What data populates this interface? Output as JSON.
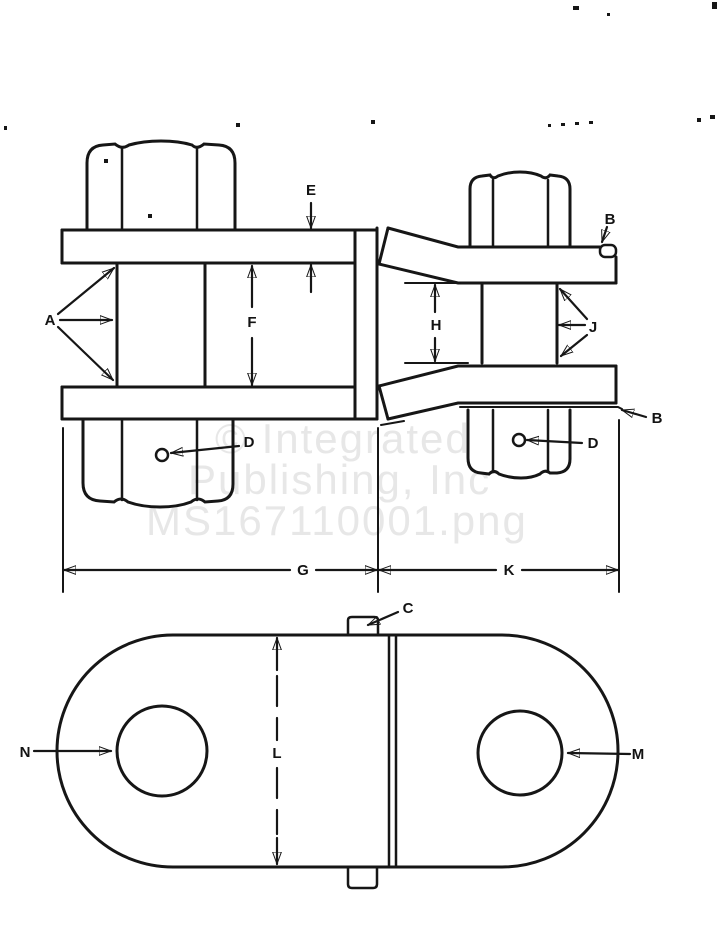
{
  "drawing": {
    "watermark": {
      "line1": "© Integrated",
      "line2": "Publishing, Inc",
      "line3": "MS167110001.png"
    },
    "labels": {
      "A": "A",
      "B_top": "B",
      "B_bottom": "B",
      "C": "C",
      "D_left": "D",
      "D_right": "D",
      "E": "E",
      "F": "F",
      "G": "G",
      "H": "H",
      "J": "J",
      "K": "K",
      "L": "L",
      "M": "M",
      "N": "N"
    },
    "colors": {
      "ink": "#161616",
      "paper": "#ffffff",
      "watermark": "#e7e7e7"
    }
  }
}
